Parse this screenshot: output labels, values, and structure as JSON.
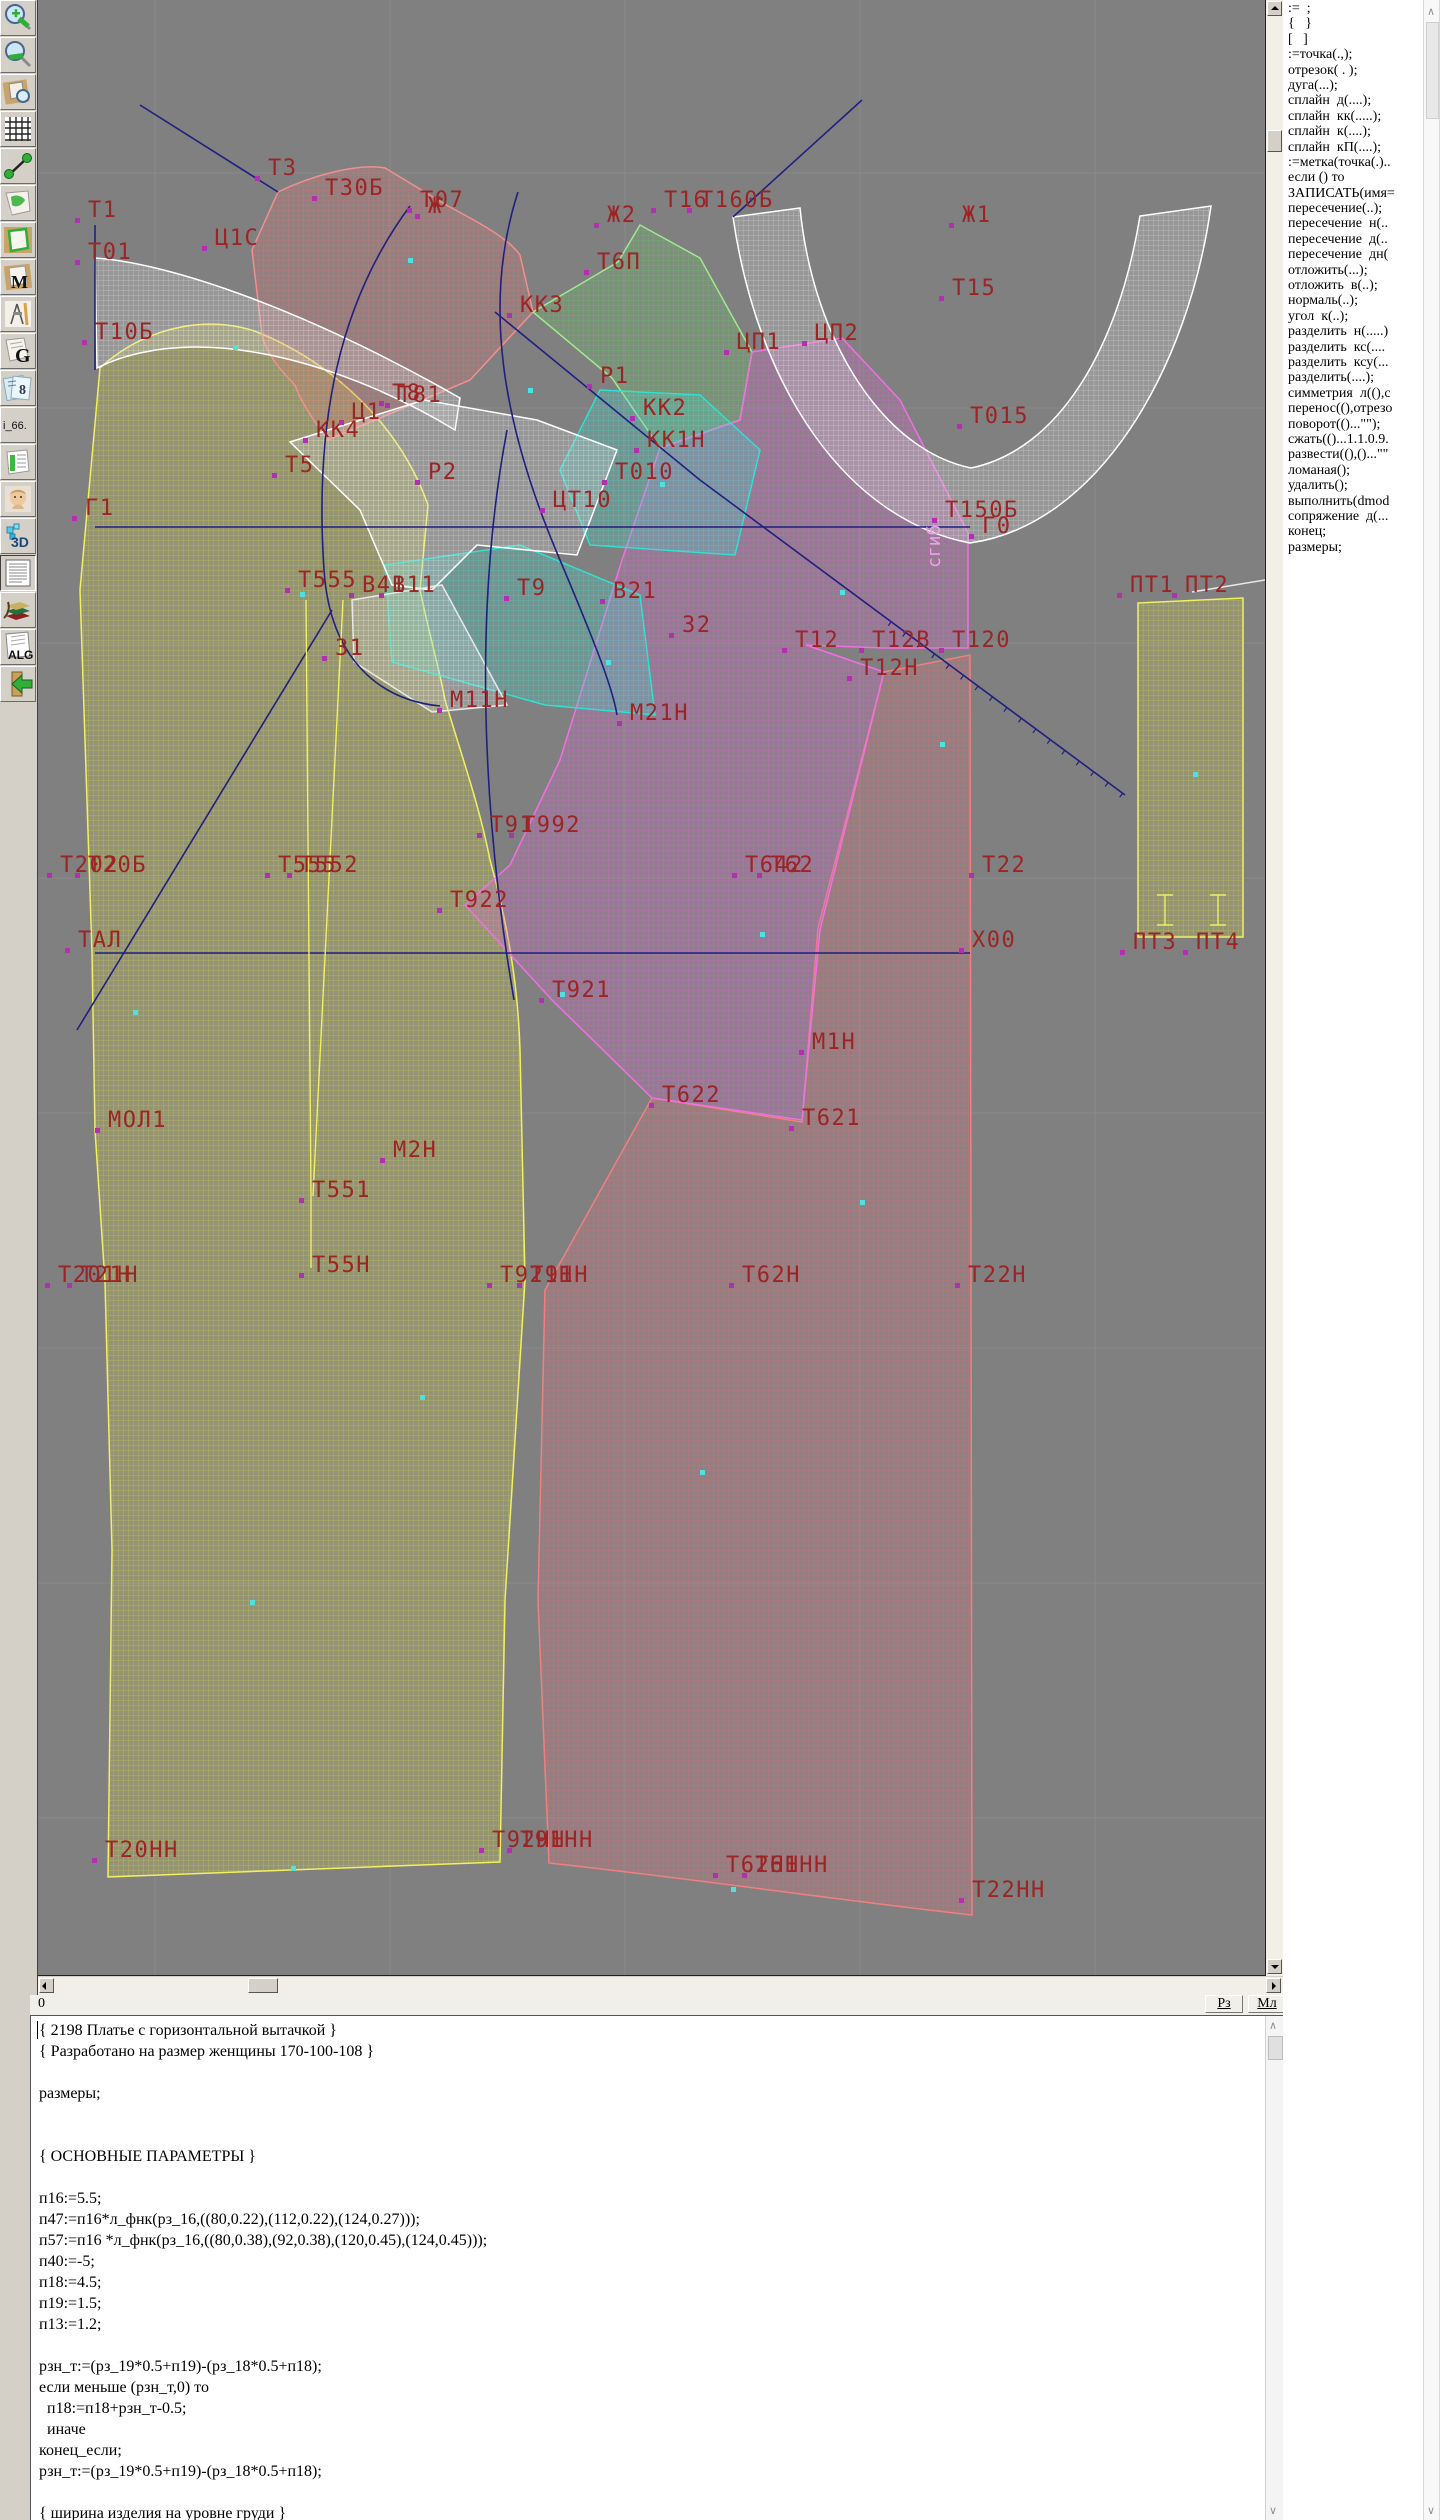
{
  "colors": {
    "canvas_bg": "#808080",
    "grid": "#8a8a8a",
    "label": "#9c2424",
    "marker_magenta": "#b030b0",
    "marker_cyan": "#50e0e0",
    "piece_yellow": "#d8d848",
    "piece_pink": "#e07878",
    "piece_green": "#6cc868",
    "piece_cyan": "#40e0d0",
    "piece_white": "#e8e8e8",
    "piece_magenta": "#d868d0",
    "piece_red": "#e07080",
    "construction_line": "#202080"
  },
  "toolbar": {
    "icons": [
      {
        "name": "zoom-in-icon"
      },
      {
        "name": "zoom-out-icon"
      },
      {
        "name": "preview-zoom-icon"
      },
      {
        "name": "grid-icon"
      },
      {
        "name": "measure-icon"
      },
      {
        "name": "page-map-icon"
      },
      {
        "name": "pattern-outline-icon"
      },
      {
        "name": "pattern-m-icon"
      },
      {
        "name": "drafting-tools-icon"
      },
      {
        "name": "g-doc-icon"
      },
      {
        "name": "sizes-icon"
      },
      {
        "name": "i66-icon"
      },
      {
        "name": "table-icon"
      },
      {
        "name": "photo-icon"
      },
      {
        "name": "3d-icon"
      },
      {
        "name": "text-doc-icon"
      },
      {
        "name": "books-icon"
      },
      {
        "name": "alg-doc-icon"
      },
      {
        "name": "exit-icon"
      }
    ],
    "i66_text": "i_66.",
    "alg_text": "ALG",
    "threed_text": "3D",
    "m_text": "M",
    "g_text": "G"
  },
  "canvas": {
    "fold_label": {
      "t": "сгиб",
      "x": 902,
      "y": 568
    },
    "labels": [
      {
        "t": "Т1",
        "x": 50,
        "y": 200
      },
      {
        "t": "Т01",
        "x": 50,
        "y": 242
      },
      {
        "t": "Т10Б",
        "x": 57,
        "y": 322
      },
      {
        "t": "Т3",
        "x": 230,
        "y": 158
      },
      {
        "t": "Ц1С",
        "x": 177,
        "y": 228
      },
      {
        "t": "Т30Б",
        "x": 287,
        "y": 178
      },
      {
        "t": "Ж",
        "x": 390,
        "y": 196
      },
      {
        "t": "Т07",
        "x": 382,
        "y": 190
      },
      {
        "t": "Ж2",
        "x": 569,
        "y": 205
      },
      {
        "t": "Т6П",
        "x": 559,
        "y": 252
      },
      {
        "t": "Т16",
        "x": 626,
        "y": 190
      },
      {
        "t": "Т160Б",
        "x": 662,
        "y": 190
      },
      {
        "t": "Ж1",
        "x": 924,
        "y": 205
      },
      {
        "t": "Т15",
        "x": 914,
        "y": 278
      },
      {
        "t": "КК3",
        "x": 482,
        "y": 295
      },
      {
        "t": "ЦП1",
        "x": 699,
        "y": 332
      },
      {
        "t": "ЦП2",
        "x": 777,
        "y": 323
      },
      {
        "t": "КК4",
        "x": 278,
        "y": 420
      },
      {
        "t": "Т8",
        "x": 354,
        "y": 383
      },
      {
        "t": "Т81",
        "x": 360,
        "y": 385
      },
      {
        "t": "Ц1",
        "x": 314,
        "y": 402
      },
      {
        "t": "Р1",
        "x": 562,
        "y": 366
      },
      {
        "t": "Т015",
        "x": 932,
        "y": 406
      },
      {
        "t": "Т5",
        "x": 247,
        "y": 455
      },
      {
        "t": "Р2",
        "x": 390,
        "y": 462
      },
      {
        "t": "КК2",
        "x": 605,
        "y": 398
      },
      {
        "t": "КК1Н",
        "x": 609,
        "y": 430
      },
      {
        "t": "Т010",
        "x": 577,
        "y": 462
      },
      {
        "t": "ЦТ10",
        "x": 515,
        "y": 490
      },
      {
        "t": "Т150Б",
        "x": 907,
        "y": 500
      },
      {
        "t": "Г0",
        "x": 944,
        "y": 516
      },
      {
        "t": "Г1",
        "x": 47,
        "y": 498
      },
      {
        "t": "Т555",
        "x": 260,
        "y": 570
      },
      {
        "t": "В41",
        "x": 324,
        "y": 575
      },
      {
        "t": "В11",
        "x": 354,
        "y": 575
      },
      {
        "t": "Т9",
        "x": 479,
        "y": 578
      },
      {
        "t": "В21",
        "x": 575,
        "y": 581
      },
      {
        "t": "З1",
        "x": 297,
        "y": 638
      },
      {
        "t": "З2",
        "x": 644,
        "y": 615
      },
      {
        "t": "Т12",
        "x": 757,
        "y": 630
      },
      {
        "t": "Т12В",
        "x": 834,
        "y": 630
      },
      {
        "t": "Т120",
        "x": 914,
        "y": 630
      },
      {
        "t": "Т12Н",
        "x": 822,
        "y": 658
      },
      {
        "t": "М11Н",
        "x": 412,
        "y": 690
      },
      {
        "t": "М21Н",
        "x": 592,
        "y": 703
      },
      {
        "t": "Т91",
        "x": 452,
        "y": 815
      },
      {
        "t": "Т992",
        "x": 484,
        "y": 815
      },
      {
        "t": "Т202",
        "x": 22,
        "y": 855
      },
      {
        "t": "Т20Б",
        "x": 50,
        "y": 855
      },
      {
        "t": "Т555",
        "x": 240,
        "y": 855
      },
      {
        "t": "Т552",
        "x": 262,
        "y": 855
      },
      {
        "t": "Т642",
        "x": 707,
        "y": 855
      },
      {
        "t": "Т62",
        "x": 732,
        "y": 855
      },
      {
        "t": "Т22",
        "x": 944,
        "y": 855
      },
      {
        "t": "Т922",
        "x": 412,
        "y": 890
      },
      {
        "t": "ТАЛ",
        "x": 40,
        "y": 930
      },
      {
        "t": "Х00",
        "x": 934,
        "y": 930
      },
      {
        "t": "Т921",
        "x": 514,
        "y": 980
      },
      {
        "t": "М1Н",
        "x": 774,
        "y": 1032
      },
      {
        "t": "Т622",
        "x": 624,
        "y": 1085
      },
      {
        "t": "Т621",
        "x": 764,
        "y": 1108
      },
      {
        "t": "МОЛ1",
        "x": 70,
        "y": 1110
      },
      {
        "t": "М2Н",
        "x": 355,
        "y": 1140
      },
      {
        "t": "Т551",
        "x": 274,
        "y": 1180
      },
      {
        "t": "Т55Н",
        "x": 274,
        "y": 1255
      },
      {
        "t": "Т201Н",
        "x": 20,
        "y": 1265
      },
      {
        "t": "Т21Н",
        "x": 42,
        "y": 1265
      },
      {
        "t": "Т921Н",
        "x": 462,
        "y": 1265
      },
      {
        "t": "Т91Н",
        "x": 492,
        "y": 1265
      },
      {
        "t": "Т62Н",
        "x": 704,
        "y": 1265
      },
      {
        "t": "Т22Н",
        "x": 930,
        "y": 1265
      },
      {
        "t": "Т20НН",
        "x": 67,
        "y": 1840
      },
      {
        "t": "Т92НН",
        "x": 454,
        "y": 1830
      },
      {
        "t": "Т91НН",
        "x": 482,
        "y": 1830
      },
      {
        "t": "Т62НН",
        "x": 688,
        "y": 1855
      },
      {
        "t": "Т61НН",
        "x": 717,
        "y": 1855
      },
      {
        "t": "Т22НН",
        "x": 934,
        "y": 1880
      },
      {
        "t": "ПТ1",
        "x": 1092,
        "y": 575
      },
      {
        "t": "ПТ2",
        "x": 1147,
        "y": 575
      },
      {
        "t": "ПТ3",
        "x": 1095,
        "y": 932
      },
      {
        "t": "ПТ4",
        "x": 1158,
        "y": 932
      }
    ]
  },
  "right_panel": {
    "items": [
      ":=  ;",
      "{   }",
      "[   ]",
      ":=точка(.,);",
      "отрезок( . );",
      "дуга(...);",
      "сплайн  д(....);",
      "сплайн  кк(.....);",
      "сплайн  к(....);",
      "сплайн  кП(....);",
      ":=метка(точка(.)..",
      "если () то",
      "ЗАПИСАТЬ(имя=",
      "пересечение(..);",
      "пересечение  н(..",
      "пересечение  д(..",
      "пересечение  дн(",
      "отложить(...);",
      "отложить  в(..);",
      "нормаль(..);",
      "угол  к(..);",
      "разделить  н(.....)",
      "разделить  кс(....",
      "разделить  ксу(...",
      "разделить(....);",
      "симметрия  л((),с",
      "перенос((),отрезо",
      "поворот(()...\"\");",
      "сжать(()...1.1.0.9.",
      "развести((),()...\"\"",
      "ломаная();",
      "удалить();",
      "выполнить(dmod",
      "сопряжение  д(...",
      "конец;",
      "размеры;"
    ]
  },
  "statusbar": {
    "left": "0",
    "buttons": [
      "Рз",
      "Мл"
    ]
  },
  "editor": {
    "lines": [
      "{ 2198 Платье с горизонтальной вытачкой }",
      "{ Разработано на размер женщины 170-100-108 }",
      "",
      "размеры;",
      "",
      "",
      "{ ОСНОВНЫЕ ПАРАМЕТРЫ }",
      "",
      "п16:=5.5;",
      "п47:=п16*л_фнк(рз_16,((80,0.22),(112,0.22),(124,0.27)));",
      "п57:=п16 *л_фнк(рз_16,((80,0.38),(92,0.38),(120,0.45),(124,0.45)));",
      "п40:=-5;",
      "п18:=4.5;",
      "п19:=1.5;",
      "п13:=1.2;",
      "",
      "рзн_т:=(рз_19*0.5+п19)-(рз_18*0.5+п18);",
      "если меньше (рзн_т,0) то",
      "  п18:=п18+рзн_т-0.5;",
      "  иначе",
      "конец_если;",
      "рзн_т:=(рз_19*0.5+п19)-(рз_18*0.5+п18);",
      "",
      "{ ширина изделия на уровне груди }"
    ]
  }
}
